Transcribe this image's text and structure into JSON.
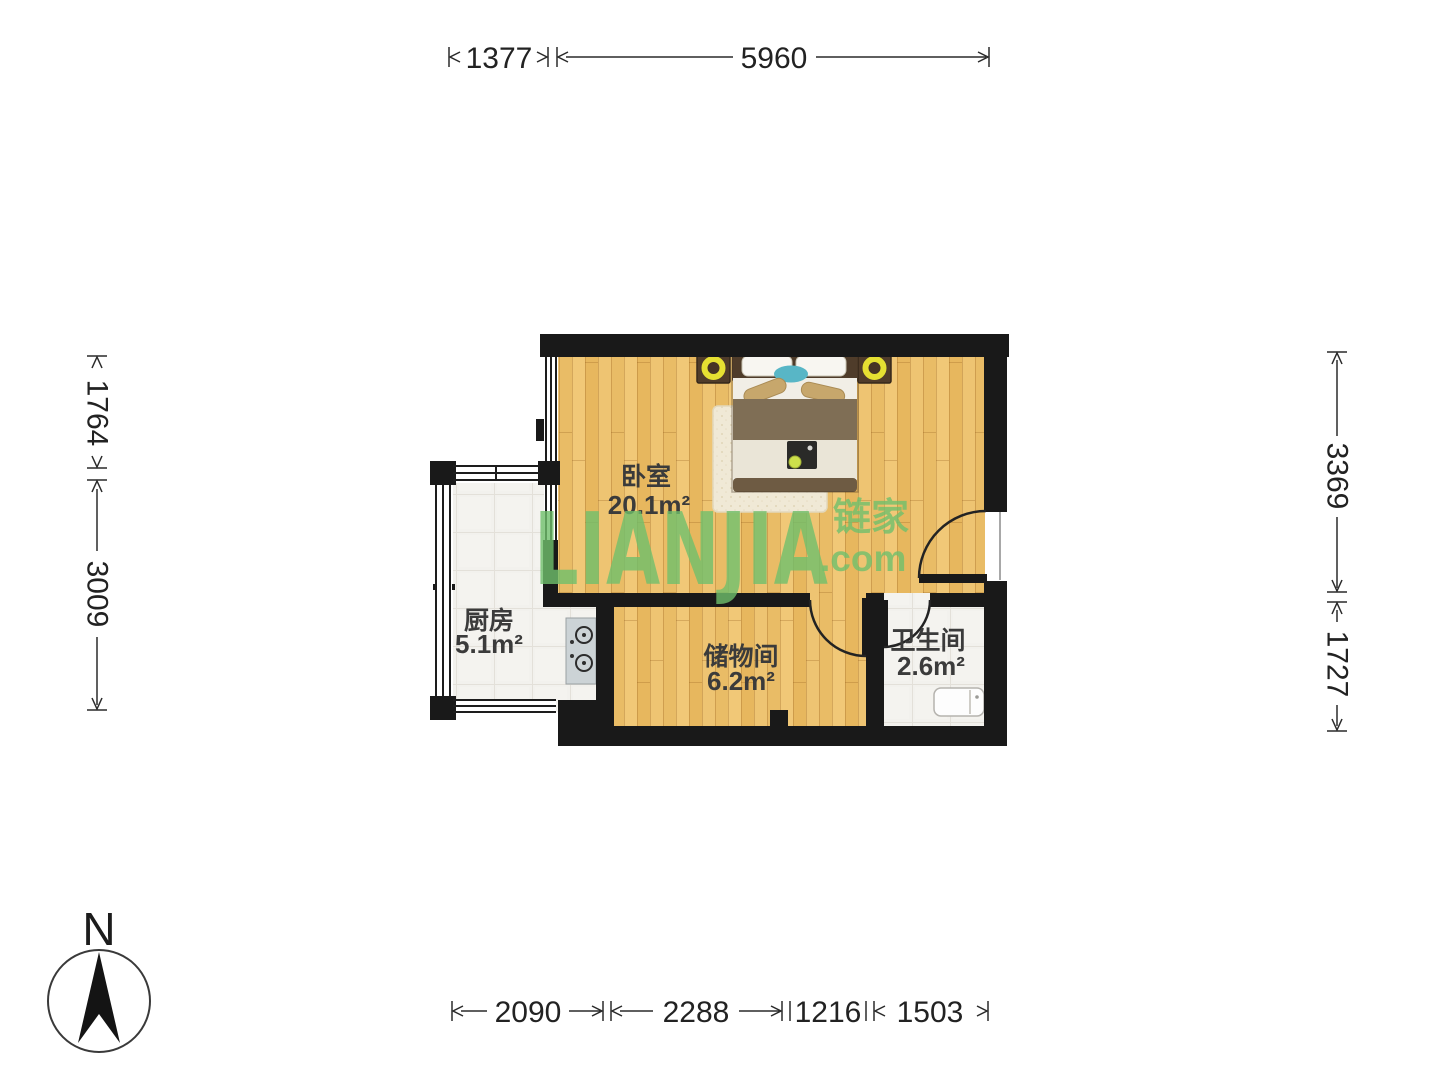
{
  "brand": {
    "logo_text": "LIANJIA",
    "logo_cn": "链家",
    "logo_domain": ".com"
  },
  "compass": {
    "label": "N"
  },
  "rooms": [
    {
      "name": "卧室",
      "area": "20.1m²"
    },
    {
      "name": "厨房",
      "area": "5.1m²"
    },
    {
      "name": "储物间",
      "area": "6.2m²"
    },
    {
      "name": "卫生间",
      "area": "2.6m²"
    }
  ],
  "dimensions": {
    "top": [
      "1377",
      "5960"
    ],
    "bottom": [
      "2090",
      "2288",
      "1216",
      "1503"
    ],
    "left": [
      "1764",
      "3009"
    ],
    "right": [
      "3369",
      "1727"
    ]
  },
  "colors": {
    "wall": "#191919",
    "wood_floor": "#ecc06a",
    "tile_floor": "#f2f1ed",
    "watermark_green": "#6fbf6b"
  }
}
